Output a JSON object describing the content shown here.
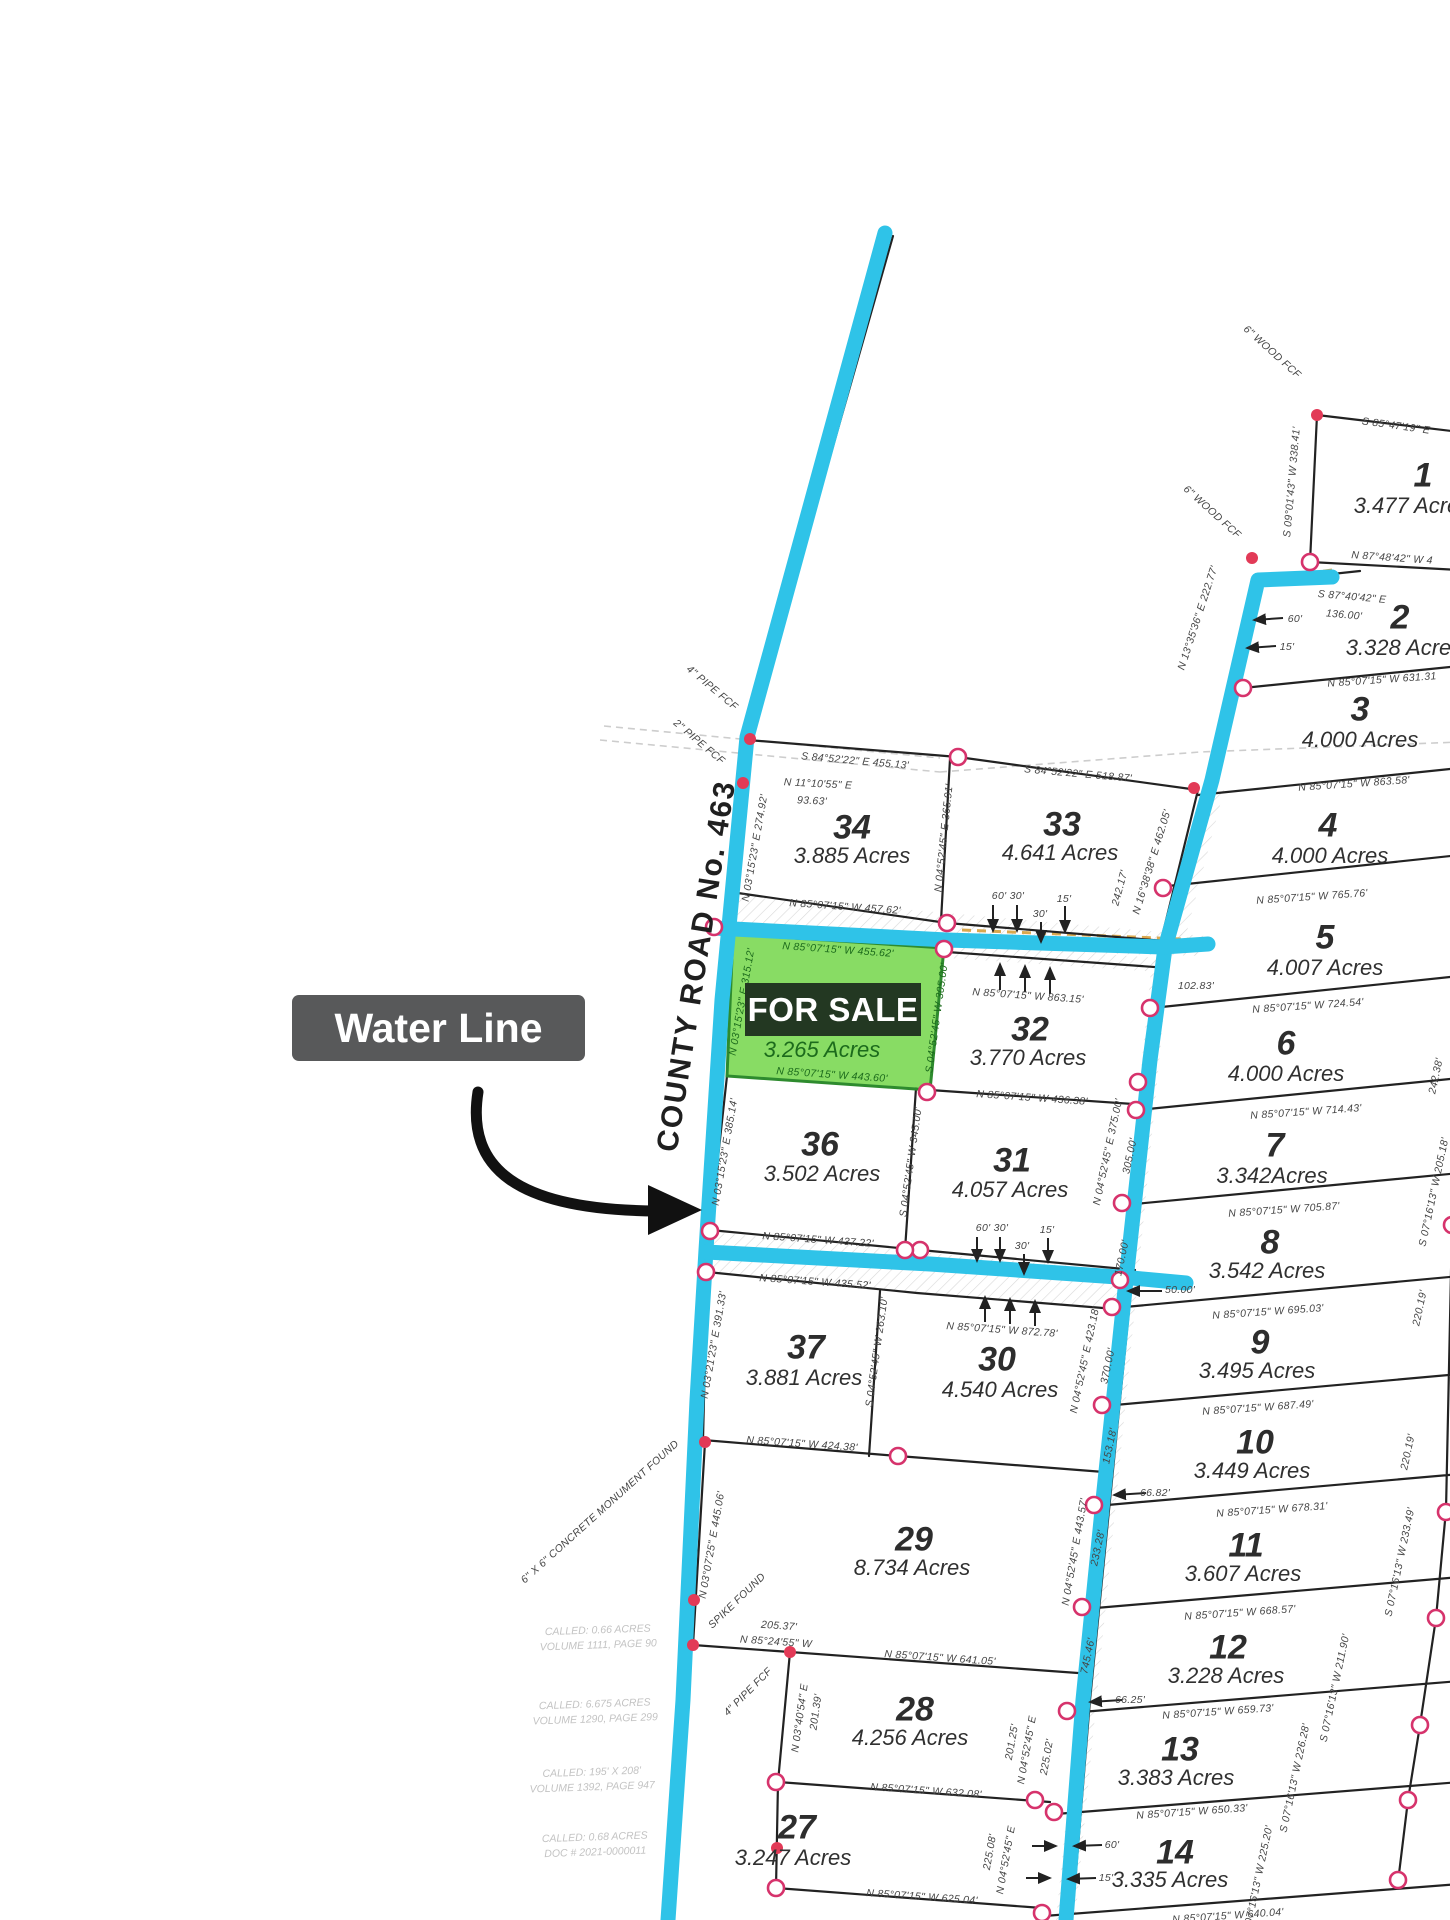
{
  "map": {
    "road_name": "COUNTY ROAD No. 463",
    "water_line_label": "Water Line",
    "for_sale": {
      "label": "FOR SALE",
      "acres": "3.265 Acres"
    },
    "colors": {
      "water_line": "#2fc3e8",
      "for_sale_fill": "#7ed957",
      "for_sale_banner": "#233822",
      "water_label_bg": "#58595a",
      "vertex_dot": "#e23a57",
      "vertex_circle": "#d6336c",
      "boundary_line": "#222222",
      "fence_dash": "#d9a84e"
    },
    "lots": [
      {
        "id": "1",
        "acres": "3.477 Acres",
        "nx": 1423,
        "ny": 476,
        "ax": 1412,
        "ay": 506
      },
      {
        "id": "2",
        "acres": "3.328 Acres",
        "nx": 1400,
        "ny": 618,
        "ax": 1404,
        "ay": 648
      },
      {
        "id": "3",
        "acres": "4.000 Acres",
        "nx": 1360,
        "ny": 710,
        "ax": 1360,
        "ay": 740
      },
      {
        "id": "4",
        "acres": "4.000 Acres",
        "nx": 1328,
        "ny": 826,
        "ax": 1330,
        "ay": 856
      },
      {
        "id": "5",
        "acres": "4.007 Acres",
        "nx": 1325,
        "ny": 938,
        "ax": 1325,
        "ay": 968
      },
      {
        "id": "6",
        "acres": "4.000 Acres",
        "nx": 1286,
        "ny": 1044,
        "ax": 1286,
        "ay": 1074
      },
      {
        "id": "7",
        "acres": "3.342Acres",
        "nx": 1275,
        "ny": 1146,
        "ax": 1272,
        "ay": 1176
      },
      {
        "id": "8",
        "acres": "3.542 Acres",
        "nx": 1270,
        "ny": 1243,
        "ax": 1267,
        "ay": 1271
      },
      {
        "id": "9",
        "acres": "3.495 Acres",
        "nx": 1260,
        "ny": 1343,
        "ax": 1257,
        "ay": 1371
      },
      {
        "id": "10",
        "acres": "3.449 Acres",
        "nx": 1255,
        "ny": 1443,
        "ax": 1252,
        "ay": 1471
      },
      {
        "id": "11",
        "acres": "3.607 Acres",
        "nx": 1246,
        "ny": 1546,
        "ax": 1243,
        "ay": 1574
      },
      {
        "id": "12",
        "acres": "3.228 Acres",
        "nx": 1228,
        "ny": 1648,
        "ax": 1226,
        "ay": 1676
      },
      {
        "id": "13",
        "acres": "3.383 Acres",
        "nx": 1180,
        "ny": 1750,
        "ax": 1176,
        "ay": 1778
      },
      {
        "id": "14",
        "acres": "3.335 Acres",
        "nx": 1175,
        "ny": 1853,
        "ax": 1170,
        "ay": 1880
      },
      {
        "id": "27",
        "acres": "3.247 Acres",
        "nx": 797,
        "ny": 1828,
        "ax": 793,
        "ay": 1858
      },
      {
        "id": "28",
        "acres": "4.256 Acres",
        "nx": 915,
        "ny": 1710,
        "ax": 910,
        "ay": 1738
      },
      {
        "id": "29",
        "acres": "8.734 Acres",
        "nx": 914,
        "ny": 1540,
        "ax": 912,
        "ay": 1568
      },
      {
        "id": "30",
        "acres": "4.540 Acres",
        "nx": 997,
        "ny": 1360,
        "ax": 1000,
        "ay": 1390
      },
      {
        "id": "31",
        "acres": "4.057 Acres",
        "nx": 1012,
        "ny": 1161,
        "ax": 1010,
        "ay": 1190
      },
      {
        "id": "32",
        "acres": "3.770 Acres",
        "nx": 1030,
        "ny": 1030,
        "ax": 1028,
        "ay": 1058
      },
      {
        "id": "33",
        "acres": "4.641 Acres",
        "nx": 1062,
        "ny": 825,
        "ax": 1060,
        "ay": 853
      },
      {
        "id": "34",
        "acres": "3.885 Acres",
        "nx": 852,
        "ny": 828,
        "ax": 852,
        "ay": 856
      },
      {
        "id": "36",
        "acres": "3.502 Acres",
        "nx": 820,
        "ny": 1145,
        "ax": 822,
        "ay": 1174
      },
      {
        "id": "37",
        "acres": "3.881 Acres",
        "nx": 806,
        "ny": 1348,
        "ax": 804,
        "ay": 1378
      }
    ],
    "bearings": [
      {
        "t": "6\" WOOD FCF",
        "x": 1272,
        "y": 352,
        "r": 42
      },
      {
        "t": "S 85°47'19\" E",
        "x": 1396,
        "y": 426,
        "r": 8
      },
      {
        "t": "S 09°01'43\" W  338.41'",
        "x": 1292,
        "y": 482,
        "r": -85
      },
      {
        "t": "6\" WOOD FCF",
        "x": 1212,
        "y": 512,
        "r": 42
      },
      {
        "t": "N 87°48'42\" W  4",
        "x": 1392,
        "y": 558,
        "r": 4
      },
      {
        "t": "S 87°40'42\" E",
        "x": 1352,
        "y": 597,
        "r": 5
      },
      {
        "t": "136.00'",
        "x": 1344,
        "y": 615,
        "r": 5
      },
      {
        "t": "N 13°35'36\" E  222.77'",
        "x": 1198,
        "y": 618,
        "r": -72
      },
      {
        "t": "60'",
        "x": 1295,
        "y": 619,
        "r": 0
      },
      {
        "t": "15'",
        "x": 1287,
        "y": 647,
        "r": 0
      },
      {
        "t": "N 85°07'15\" W  631.31",
        "x": 1382,
        "y": 680,
        "r": -4
      },
      {
        "t": "S 84°52'22\" E  455.13'",
        "x": 855,
        "y": 761,
        "r": 5
      },
      {
        "t": "S 84°52'22\" E  518.87'",
        "x": 1078,
        "y": 774,
        "r": 5
      },
      {
        "t": "N 85°07'15\" W  863.58'",
        "x": 1354,
        "y": 784,
        "r": -4
      },
      {
        "t": "N 11°10'55\" E",
        "x": 818,
        "y": 784,
        "r": 3
      },
      {
        "t": "93.63'",
        "x": 812,
        "y": 801,
        "r": 3
      },
      {
        "t": "4\" PIPE FCF",
        "x": 712,
        "y": 688,
        "r": 40
      },
      {
        "t": "2\" PIPE FCF",
        "x": 699,
        "y": 742,
        "r": 40
      },
      {
        "t": "N 16°38'38\" E  462.05'",
        "x": 1152,
        "y": 862,
        "r": -73
      },
      {
        "t": "N 03°15'23\" E  274.92'",
        "x": 755,
        "y": 848,
        "r": -80
      },
      {
        "t": "N 04°52'45\" E  365.91'",
        "x": 944,
        "y": 838,
        "r": -84
      },
      {
        "t": "N 85°07'15\" W  457.62'",
        "x": 845,
        "y": 907,
        "r": 4
      },
      {
        "t": "60'  30'",
        "x": 1008,
        "y": 896,
        "r": 0
      },
      {
        "t": "30'",
        "x": 1040,
        "y": 914,
        "r": 0
      },
      {
        "t": "15'",
        "x": 1064,
        "y": 899,
        "r": 0
      },
      {
        "t": "242.17'",
        "x": 1120,
        "y": 888,
        "r": -75
      },
      {
        "t": "N 85°07'15\" W  765.76'",
        "x": 1312,
        "y": 897,
        "r": -4
      },
      {
        "t": "N 85°07'15\" W  455.62'",
        "x": 838,
        "y": 950,
        "r": 4,
        "c": "green"
      },
      {
        "t": "N 85°07'15\" W  863.15'",
        "x": 1028,
        "y": 996,
        "r": 4
      },
      {
        "t": "102.83'",
        "x": 1196,
        "y": 986,
        "r": 0
      },
      {
        "t": "N 85°07'15\" W  724.54'",
        "x": 1308,
        "y": 1006,
        "r": -4
      },
      {
        "t": "N 03°15'23\" E  315.12'",
        "x": 742,
        "y": 1002,
        "r": -80,
        "c": "green"
      },
      {
        "t": "S 04°52'45\" W  305.00'",
        "x": 937,
        "y": 1018,
        "r": -82,
        "c": "green"
      },
      {
        "t": "N 85°07'15\" W  443.60'",
        "x": 832,
        "y": 1075,
        "r": 4,
        "c": "green"
      },
      {
        "t": "N 85°07'15\" W  436.38'",
        "x": 1032,
        "y": 1098,
        "r": 4
      },
      {
        "t": "N 85°07'15\" W  714.43'",
        "x": 1306,
        "y": 1112,
        "r": -4
      },
      {
        "t": "N 03°15'23\" E  385.14'",
        "x": 725,
        "y": 1152,
        "r": -80
      },
      {
        "t": "S 04°52'45\" W  345.00'",
        "x": 911,
        "y": 1162,
        "r": -82
      },
      {
        "t": "N 04°52'45\" E  375.00'",
        "x": 1108,
        "y": 1152,
        "r": -78
      },
      {
        "t": "305.00'",
        "x": 1130,
        "y": 1156,
        "r": -78
      },
      {
        "t": "N 85°07'15\" W  705.87'",
        "x": 1284,
        "y": 1210,
        "r": -4
      },
      {
        "t": "N 85°07'15\" W  437.22'",
        "x": 818,
        "y": 1240,
        "r": 4
      },
      {
        "t": "60'  30'",
        "x": 992,
        "y": 1228,
        "r": 0
      },
      {
        "t": "30'",
        "x": 1022,
        "y": 1246,
        "r": 0
      },
      {
        "t": "15'",
        "x": 1047,
        "y": 1230,
        "r": 0
      },
      {
        "t": "170.00'",
        "x": 1122,
        "y": 1258,
        "r": -78
      },
      {
        "t": "N 85°07'15\" W  435.52'",
        "x": 815,
        "y": 1282,
        "r": 4
      },
      {
        "t": "50.00'",
        "x": 1180,
        "y": 1290,
        "r": 0
      },
      {
        "t": "N 85°07'15\" W  695.03'",
        "x": 1268,
        "y": 1312,
        "r": -4
      },
      {
        "t": "N 85°07'15\" W  872.78'",
        "x": 1002,
        "y": 1330,
        "r": 4
      },
      {
        "t": "N 03°21'23\" E  391.33'",
        "x": 714,
        "y": 1345,
        "r": -80
      },
      {
        "t": "S 04°52'45\" W  263.10'",
        "x": 877,
        "y": 1352,
        "r": -82
      },
      {
        "t": "N 04°52'45\" E  423.18'",
        "x": 1085,
        "y": 1360,
        "r": -78
      },
      {
        "t": "370.00'",
        "x": 1108,
        "y": 1366,
        "r": -78
      },
      {
        "t": "N 85°07'15\" W  687.49'",
        "x": 1258,
        "y": 1408,
        "r": -4
      },
      {
        "t": "N 85°07'15\" W  424.38'",
        "x": 802,
        "y": 1444,
        "r": 4
      },
      {
        "t": "153.18'",
        "x": 1110,
        "y": 1446,
        "r": -78
      },
      {
        "t": "66.82'",
        "x": 1155,
        "y": 1493,
        "r": 0
      },
      {
        "t": "N 85°07'15\" W  678.31'",
        "x": 1272,
        "y": 1510,
        "r": -4
      },
      {
        "t": "6\" X 6\" CONCRETE MONUMENT FOUND",
        "x": 600,
        "y": 1512,
        "r": -42
      },
      {
        "t": "N 03°07'25\" E  445.06'",
        "x": 712,
        "y": 1545,
        "r": -80
      },
      {
        "t": "N 04°52'45\" E  443.57'",
        "x": 1075,
        "y": 1552,
        "r": -80
      },
      {
        "t": "233.28'",
        "x": 1098,
        "y": 1548,
        "r": -78
      },
      {
        "t": "SPIKE FOUND",
        "x": 737,
        "y": 1601,
        "r": -44
      },
      {
        "t": "N 85°07'15\" W  668.57'",
        "x": 1240,
        "y": 1613,
        "r": -4
      },
      {
        "t": "205.37'",
        "x": 779,
        "y": 1626,
        "r": 4
      },
      {
        "t": "N 85°24'55\" W",
        "x": 776,
        "y": 1642,
        "r": 4
      },
      {
        "t": "N 85°07'15\" W  641.05'",
        "x": 940,
        "y": 1658,
        "r": 4
      },
      {
        "t": "745.46'",
        "x": 1088,
        "y": 1656,
        "r": -78
      },
      {
        "t": "4\" PIPE FCF",
        "x": 748,
        "y": 1692,
        "r": -45
      },
      {
        "t": "N 03°40'54\" E",
        "x": 800,
        "y": 1718,
        "r": -82
      },
      {
        "t": "201.39'",
        "x": 816,
        "y": 1712,
        "r": -82
      },
      {
        "t": "66.25'",
        "x": 1130,
        "y": 1700,
        "r": 0
      },
      {
        "t": "N 85°07'15\" W  659.73'",
        "x": 1218,
        "y": 1712,
        "r": -4
      },
      {
        "t": "201.25'",
        "x": 1012,
        "y": 1742,
        "r": -80
      },
      {
        "t": "N 04°52'45\" E",
        "x": 1027,
        "y": 1750,
        "r": -80
      },
      {
        "t": "225.02'",
        "x": 1047,
        "y": 1757,
        "r": -80
      },
      {
        "t": "N 85°07'15\" W  632.08'",
        "x": 926,
        "y": 1791,
        "r": 4
      },
      {
        "t": "N 85°07'15\" W  650.33'",
        "x": 1192,
        "y": 1812,
        "r": -4
      },
      {
        "t": "60'",
        "x": 1112,
        "y": 1845,
        "r": 0
      },
      {
        "t": "15'",
        "x": 1106,
        "y": 1878,
        "r": 0
      },
      {
        "t": "225.08'",
        "x": 990,
        "y": 1852,
        "r": -80
      },
      {
        "t": "N 04°52'45\" E",
        "x": 1006,
        "y": 1860,
        "r": -80
      },
      {
        "t": "N 85°07'15\" W  625.04'",
        "x": 922,
        "y": 1897,
        "r": 4
      },
      {
        "t": "N 85°07'15\" W  640.04'",
        "x": 1228,
        "y": 1916,
        "r": -4
      },
      {
        "t": "242.38'",
        "x": 1436,
        "y": 1076,
        "r": -78
      },
      {
        "t": "S 07°16'13\" W  205.18'",
        "x": 1434,
        "y": 1192,
        "r": -78
      },
      {
        "t": "220.19'",
        "x": 1420,
        "y": 1308,
        "r": -78
      },
      {
        "t": "220.19'",
        "x": 1408,
        "y": 1452,
        "r": -78
      },
      {
        "t": "S 07°16'13\" W  233.49'",
        "x": 1400,
        "y": 1562,
        "r": -78
      },
      {
        "t": "S 07°16'13\" W  211.90'",
        "x": 1335,
        "y": 1688,
        "r": -78
      },
      {
        "t": "S 07°16'13\" W  226.28'",
        "x": 1295,
        "y": 1778,
        "r": -78
      },
      {
        "t": "S 07°16'13\" W  225.20'",
        "x": 1258,
        "y": 1880,
        "r": -78
      }
    ],
    "called_notes": [
      {
        "l1": "CALLED: 0.66 ACRES",
        "l2": "VOLUME 1111, PAGE 90",
        "x": 598,
        "y": 1638
      },
      {
        "l1": "CALLED: 6.675 ACRES",
        "l2": "VOLUME 1290, PAGE 299",
        "x": 595,
        "y": 1712
      },
      {
        "l1": "CALLED: 195' X 208'",
        "l2": "VOLUME 1392, PAGE 947",
        "x": 592,
        "y": 1780
      },
      {
        "l1": "CALLED: 0.68 ACRES",
        "l2": "DOC # 2021-0000011",
        "x": 595,
        "y": 1845
      }
    ]
  }
}
